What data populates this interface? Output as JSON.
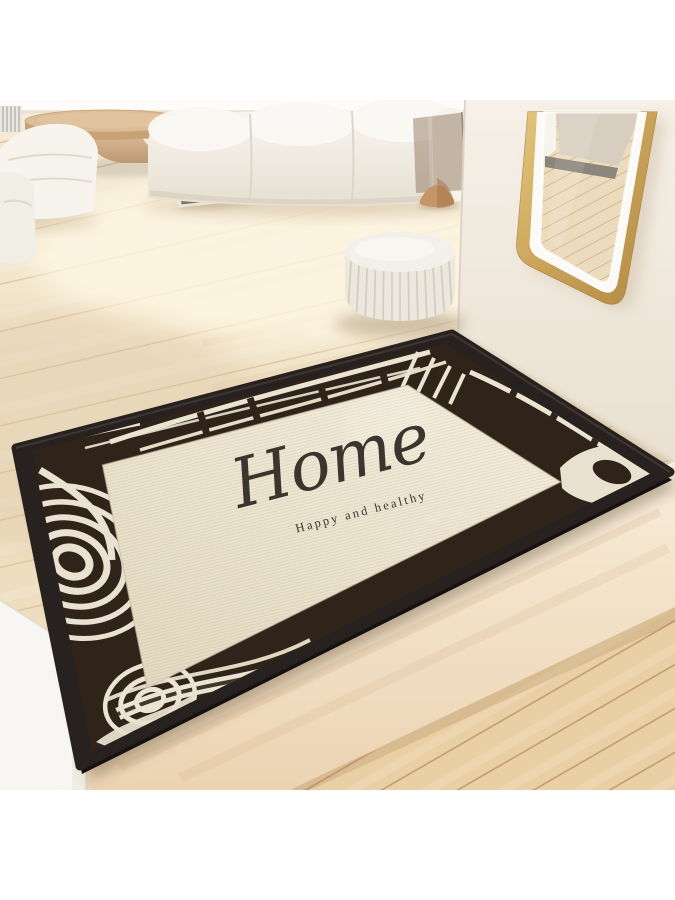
{
  "mat": {
    "title": "Home",
    "subtitle": "Happy and healthy"
  },
  "colors": {
    "mat_field": "#efe7d3",
    "mat_border_dark": "#30241a",
    "mat_binding": "#272120",
    "mat_stripe_light": "#ece4d2",
    "text_color": "#3b352d",
    "floor_upper": "#f1e5cc",
    "floor_lower": "#e9cfa4",
    "step_face": "#f5e7d2",
    "wall": "#f2ebe1",
    "mirror_gold": "#c9a258",
    "sofa_white": "#f5f2ec",
    "table_wood": "#d9b990",
    "pouf": "#ece8de"
  }
}
